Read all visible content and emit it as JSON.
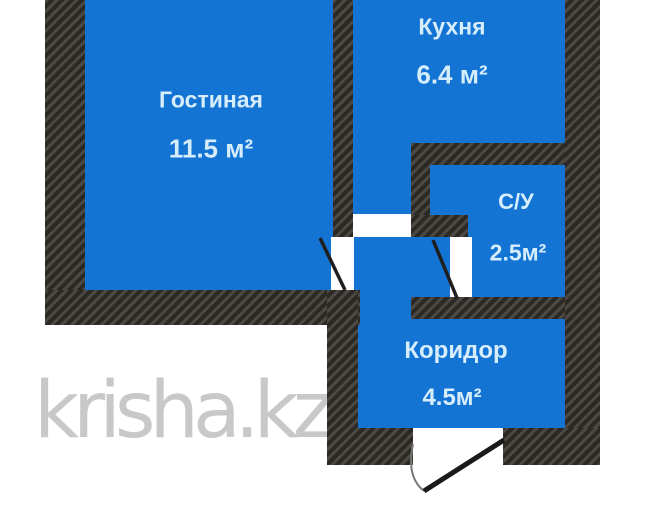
{
  "floorplan": {
    "rooms": [
      {
        "id": "living",
        "name": "Гостиная",
        "area": "11.5 м²"
      },
      {
        "id": "kitchen",
        "name": "Кухня",
        "area": "6.4 м²"
      },
      {
        "id": "bathroom",
        "name": "С/У",
        "area": "2.5м²"
      },
      {
        "id": "corridor",
        "name": "Коридор",
        "area": "4.5м²"
      }
    ],
    "colors": {
      "room_fill": "#1474d4",
      "wall": "#38342f",
      "label": "#d6eefb",
      "watermark": "#c8c8c8"
    }
  },
  "watermark": {
    "text": "krisha.kz"
  }
}
